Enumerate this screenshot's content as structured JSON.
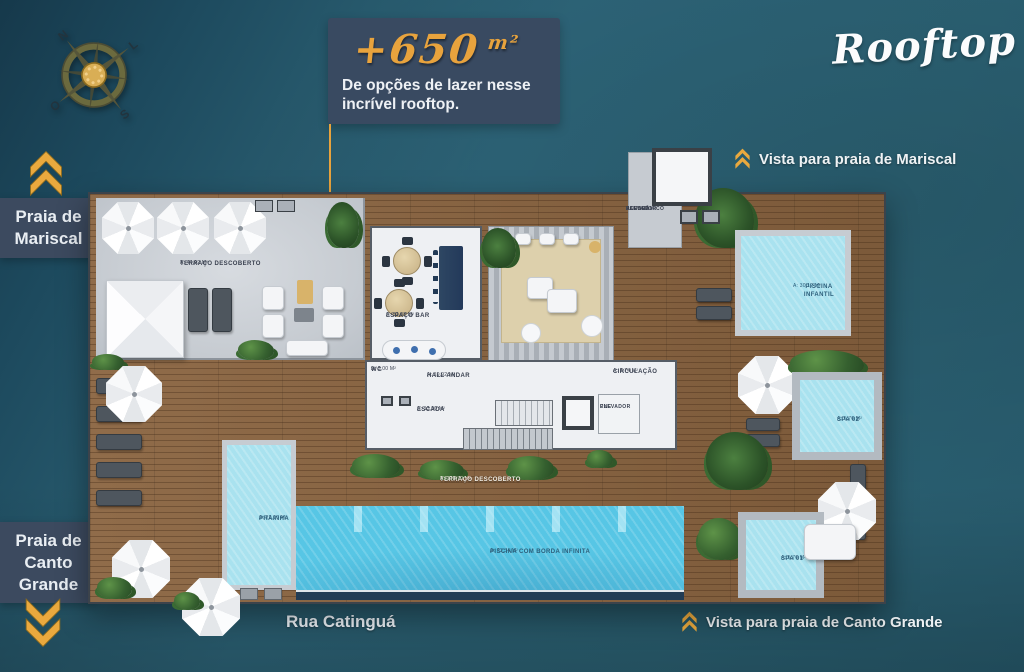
{
  "page": {
    "title": "Rooftop",
    "banner": {
      "headline_value": "+650",
      "headline_unit": "m²",
      "subline1": "De opções de lazer nesse",
      "subline2": "incrível rooftop."
    },
    "street_label": "Rua Catinguá"
  },
  "compass": {
    "north": "N",
    "east": "L",
    "south": "S",
    "west": "O"
  },
  "beach_labels": {
    "mariscal": {
      "line1": "Praia de",
      "line2": "Mariscal"
    },
    "canto_grande": {
      "line1": "Praia de",
      "line2": "Canto",
      "line3": "Grande"
    },
    "vista_mariscal": "Vista para praia de Mariscal",
    "vista_canto_grande": "Vista para praia de Canto Grande"
  },
  "plan": {
    "rooms": {
      "terraco_descoberto": {
        "name": "TERRAÇO DESCOBERTO",
        "area": "A: 44,92 m²"
      },
      "espaco_bar": {
        "name": "ESPAÇO BAR",
        "area": "A: 32,08 m²"
      },
      "wc": {
        "name": "WC",
        "area": "A: 3,00 m²"
      },
      "hall_andar": {
        "name": "HALL ANDAR",
        "area": "A: 19,92 m²"
      },
      "escada": {
        "name": "ESCADA",
        "area": "A: 13,90 m²"
      },
      "circulacao": {
        "name": "CIRCULAÇÃO",
        "area": "A: 3,74 m²"
      },
      "elevador_pne": {
        "line1": "ELEVADOR",
        "line2": "PNE"
      },
      "acesso_elevador": {
        "line1": "ACESSO",
        "line2": "ELEVADOR",
        "line3": "PANORÂMICO"
      },
      "piscina_infantil": {
        "name": "PISCINA INFANTIL",
        "area": "A: 30,12 m²"
      },
      "spa02": {
        "name": "SPA 02",
        "area": "A: 5,76 m²"
      },
      "spa01": {
        "name": "SPA 01",
        "area": "A: 5,76 m²"
      },
      "prainha": {
        "name": "PRAINHA",
        "area": "A: 22,16 m²"
      },
      "piscina_borda": {
        "name": "PISCINA COM BORDA INFINITA",
        "area": "A: 73,34 m²"
      },
      "terraco_descoberto_2": {
        "name": "TERRAÇO DESCOBERTO",
        "area": "A: 170,70 m²"
      }
    }
  },
  "colors": {
    "background_teal": "#2d6478",
    "background_dark": "#16394b",
    "banner_navy": "#394a61",
    "accent_gold": "#e8a33d",
    "wood_deck": "#8a6440",
    "water_light": "#a9e2ef",
    "water_deep": "#57c6e5"
  }
}
